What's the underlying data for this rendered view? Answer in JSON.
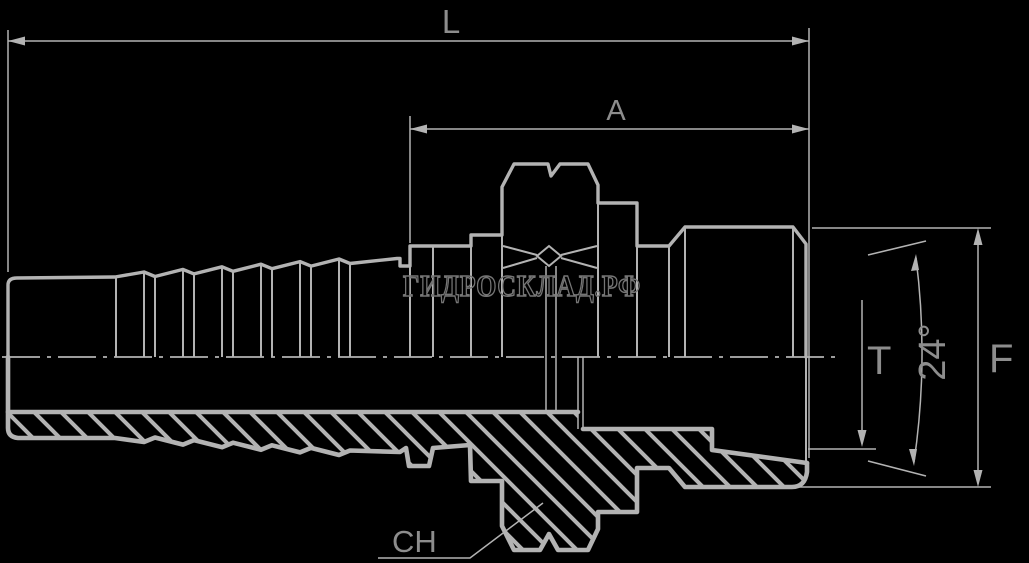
{
  "labels": {
    "overall_length": "L",
    "thread_section_length": "A",
    "seat_diameter": "T",
    "cone_angle": "24°",
    "end_diameter": "F",
    "hex_size": "CH"
  },
  "watermark": {
    "text": "ГИДРОСКЛАД.РФ"
  },
  "colors": {
    "background": "#000000",
    "line": "#b3b3b3",
    "dimension_label": "#8d8d8d",
    "watermark_outline": "#757575"
  }
}
